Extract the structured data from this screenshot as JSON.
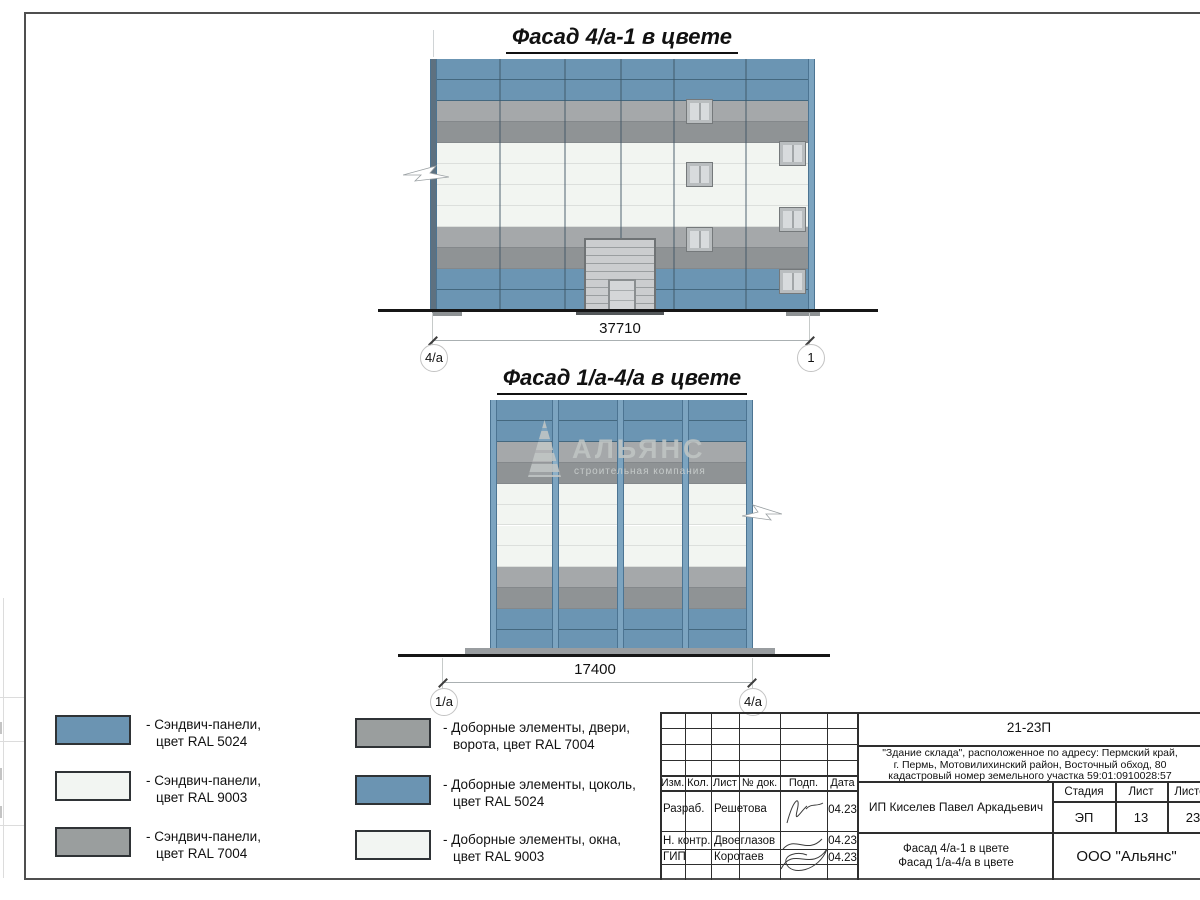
{
  "drawings": {
    "facade1": {
      "title": "Фасад 4/а-1 в цвете",
      "dimension": "37710",
      "axis_left": "4/а",
      "axis_right": "1"
    },
    "facade2": {
      "title": "Фасад 1/а-4/а в цвете",
      "dimension": "17400",
      "axis_left": "1/а",
      "axis_right": "4/а"
    }
  },
  "watermark": {
    "name": "АЛЬЯНС",
    "tagline": "строительная компания"
  },
  "colors": {
    "ral_5024_panel": "#6b95b3",
    "ral_5024_seam": "#44687f",
    "ral_7004_light": "#a5a8aa",
    "ral_7004_dark": "#8f9395",
    "ral_7004_seam": "#84888b",
    "ral_9003_panel": "#f2f5f1",
    "ral_9003_seam": "#dcdfdc",
    "pilaster_light": "#7ca4c0",
    "pilaster_edge": "#4c7492",
    "pilaster_dark": "#5e7180",
    "legend_blue": "#6b94b2",
    "legend_white": "#f2f5f2",
    "legend_gray": "#9a9e9e"
  },
  "facades": [
    {
      "geom": {
        "left": 430,
        "top": 59,
        "width": 385,
        "height": 252
      },
      "rows": [
        "blue",
        "blue",
        "gray1",
        "gray2",
        "white",
        "white",
        "white",
        "white",
        "gray1",
        "gray2",
        "blue",
        "blue"
      ],
      "verticals": [
        69,
        134,
        190,
        243,
        315
      ],
      "pilasters": [
        {
          "x": 0,
          "w": 7,
          "type": "dark"
        },
        {
          "x": 378,
          "w": 7,
          "type": "light"
        }
      ],
      "windows": [
        {
          "x": 256,
          "y": 40
        },
        {
          "x": 256,
          "y": 103
        },
        {
          "x": 256,
          "y": 168
        },
        {
          "x": 349,
          "y": 82
        },
        {
          "x": 349,
          "y": 148
        },
        {
          "x": 349,
          "y": 210
        }
      ],
      "gate": {
        "x": 154,
        "y": 179,
        "w": 72,
        "h": 73,
        "door": {
          "x": 22,
          "y": 39,
          "w": 28,
          "h": 34
        }
      }
    },
    {
      "geom": {
        "left": 490,
        "top": 400,
        "width": 263,
        "height": 251
      },
      "rows": [
        "blue",
        "blue",
        "gray1",
        "gray2",
        "white",
        "white",
        "white",
        "white",
        "gray1",
        "gray2",
        "blue",
        "blue"
      ],
      "verticals": [],
      "pilasters": [
        {
          "x": 0,
          "w": 7,
          "type": "light"
        },
        {
          "x": 62,
          "w": 7,
          "type": "light"
        },
        {
          "x": 127,
          "w": 7,
          "type": "light"
        },
        {
          "x": 192,
          "w": 7,
          "type": "light"
        },
        {
          "x": 256,
          "w": 7,
          "type": "light"
        }
      ],
      "windows": [],
      "gate": null
    }
  ],
  "legend": {
    "items": [
      {
        "line1": "- Сэндвич-панели,",
        "line2": "цвет RAL 5024",
        "color": "#6b94b2"
      },
      {
        "line1": "- Сэндвич-панели,",
        "line2": "цвет RAL 9003",
        "color": "#f2f5f2"
      },
      {
        "line1": "- Сэндвич-панели,",
        "line2": "цвет RAL 7004",
        "color": "#9a9e9e"
      },
      {
        "line1": "- Доборные элементы, двери,",
        "line2": "ворота, цвет RAL 7004",
        "color": "#9a9e9e"
      },
      {
        "line1": "- Доборные элементы, цоколь,",
        "line2": "цвет RAL 5024",
        "color": "#6b94b2"
      },
      {
        "line1": "- Доборные элементы, окна,",
        "line2": "цвет RAL 9003",
        "color": "#f2f5f2"
      }
    ]
  },
  "titleblock": {
    "doc_number": "21-23П",
    "address_line1": "\"Здание склада\", расположенное по адресу: Пермский край,",
    "address_line2": "г. Пермь, Мотовилихинский район, Восточный обход, 80",
    "address_line3": "кадастровый номер земельного участка 59:01:0910028:57",
    "header_cols": [
      "Изм.",
      "Кол.",
      "Лист",
      "№ док.",
      "Подп.",
      "Дата"
    ],
    "rows": [
      {
        "role": "Разраб.",
        "name": "Решетова",
        "date": "04.23"
      },
      {
        "role": "Н. контр.",
        "name": "Двоеглазов",
        "date": "04.23"
      },
      {
        "role": "ГИП",
        "name": "Коротаев",
        "date": "04.23"
      }
    ],
    "client": "ИП Киселев Павел Аркадьевич",
    "stage_label": "Стадия",
    "sheet_label": "Лист",
    "sheets_label": "Листов",
    "stage": "ЭП",
    "sheet": "13",
    "sheets": "23",
    "sheet_title_line1": "Фасад 4/а-1 в цвете",
    "sheet_title_line2": "Фасад 1/а-4/а в цвете",
    "company": "ООО \"Альянс\""
  }
}
